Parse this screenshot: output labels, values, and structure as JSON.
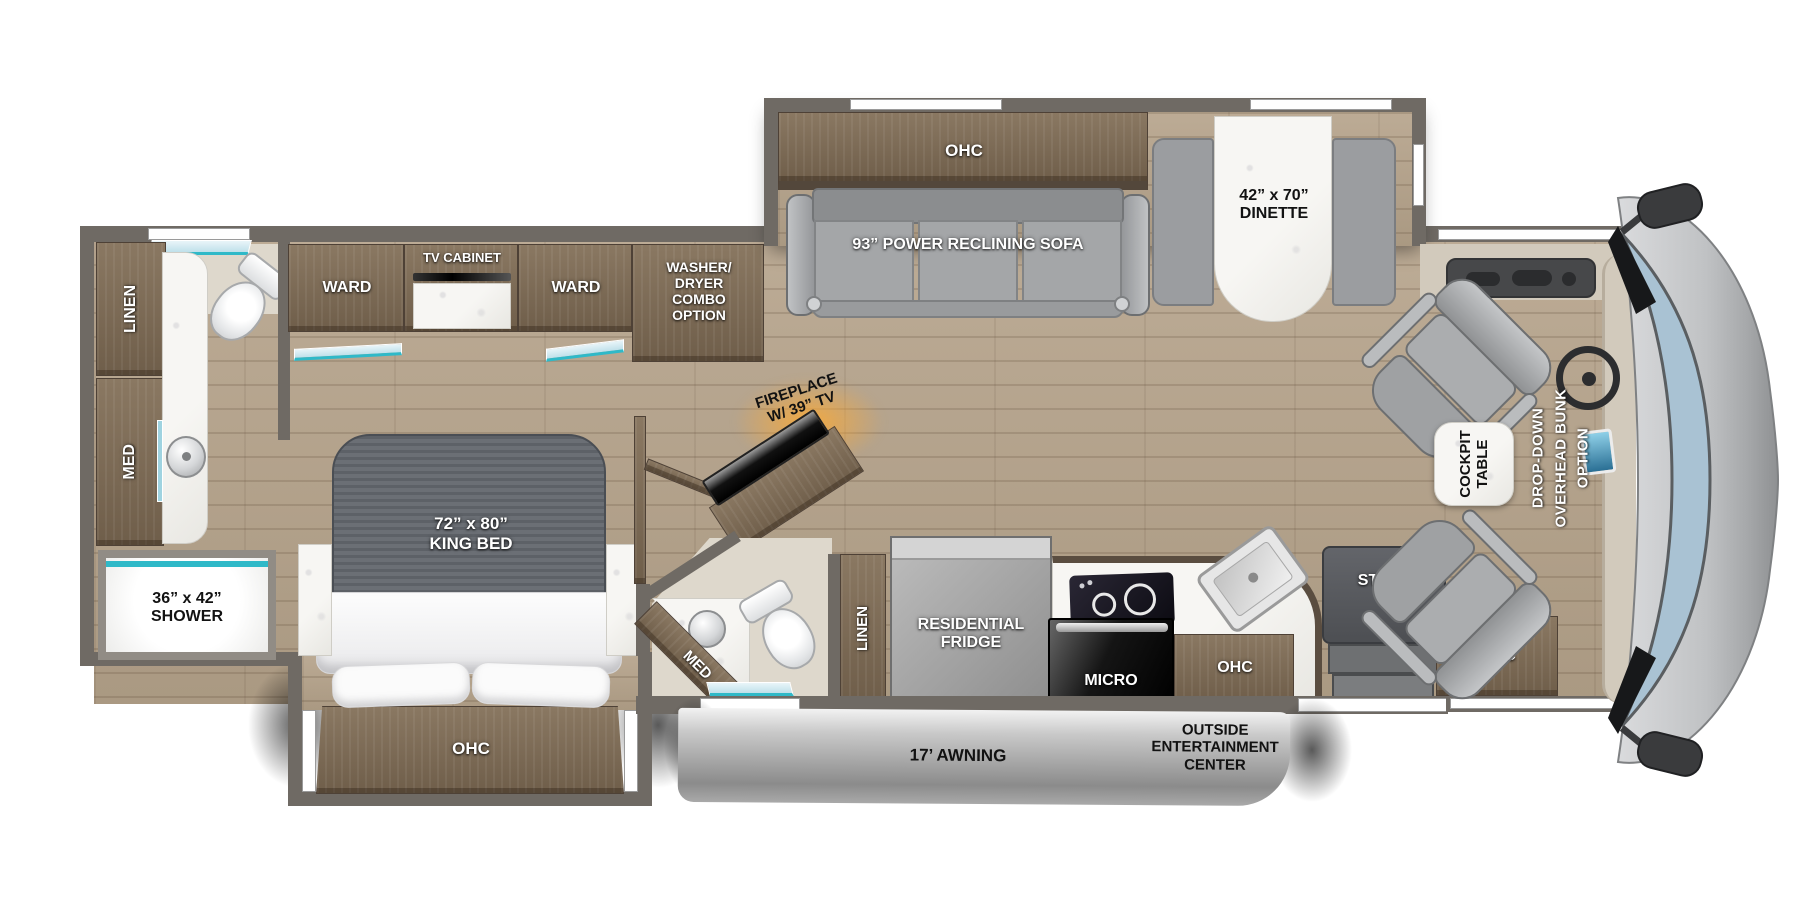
{
  "plan": {
    "name": "RV floor plan"
  },
  "colors": {
    "accent_teal": "#2FB9C8",
    "wall": "#6F6A64",
    "cabinet_wood": "#7C6A57",
    "floor_wood": "#B6A48E",
    "sofa_gray": "#A4A6A8",
    "windshield_blue": "#A9C2D3",
    "fireplace_glow": "#F5A93C",
    "awning_gray": "#BDBDBD"
  },
  "rear_bath": {
    "linen": "LINEN",
    "med": "MED",
    "shower": "36” x 42”\nSHOWER"
  },
  "bedroom": {
    "ward_left": "WARD",
    "tv_cabinet": "TV CABINET",
    "ward_right": "WARD",
    "washer_dryer": "WASHER/\nDRYER\nCOMBO\nOPTION",
    "king_bed": "72” x 80”\nKING BED",
    "ohc": "OHC"
  },
  "living": {
    "ohc": "OHC",
    "sofa": "93” POWER RECLINING SOFA",
    "dinette": "42” x 70”\nDINETTE",
    "fireplace": "FIREPLACE\nW/ 39” TV"
  },
  "mid_bath": {
    "med": "MED",
    "linen": "LINEN"
  },
  "kitchen": {
    "fridge": "RESIDENTIAL\nFRIDGE",
    "micro": "MICRO",
    "ohc": "OHC"
  },
  "entry": {
    "steps": "STEPS",
    "ohc": "OHC"
  },
  "cockpit": {
    "table": "COCKPIT\nTABLE",
    "bunk": "DROP-DOWN\nOVERHEAD BUNK\nOPTION"
  },
  "exterior": {
    "awning": "17’ AWNING",
    "entertainment_center": "OUTSIDE\nENTERTAINMENT\nCENTER"
  }
}
